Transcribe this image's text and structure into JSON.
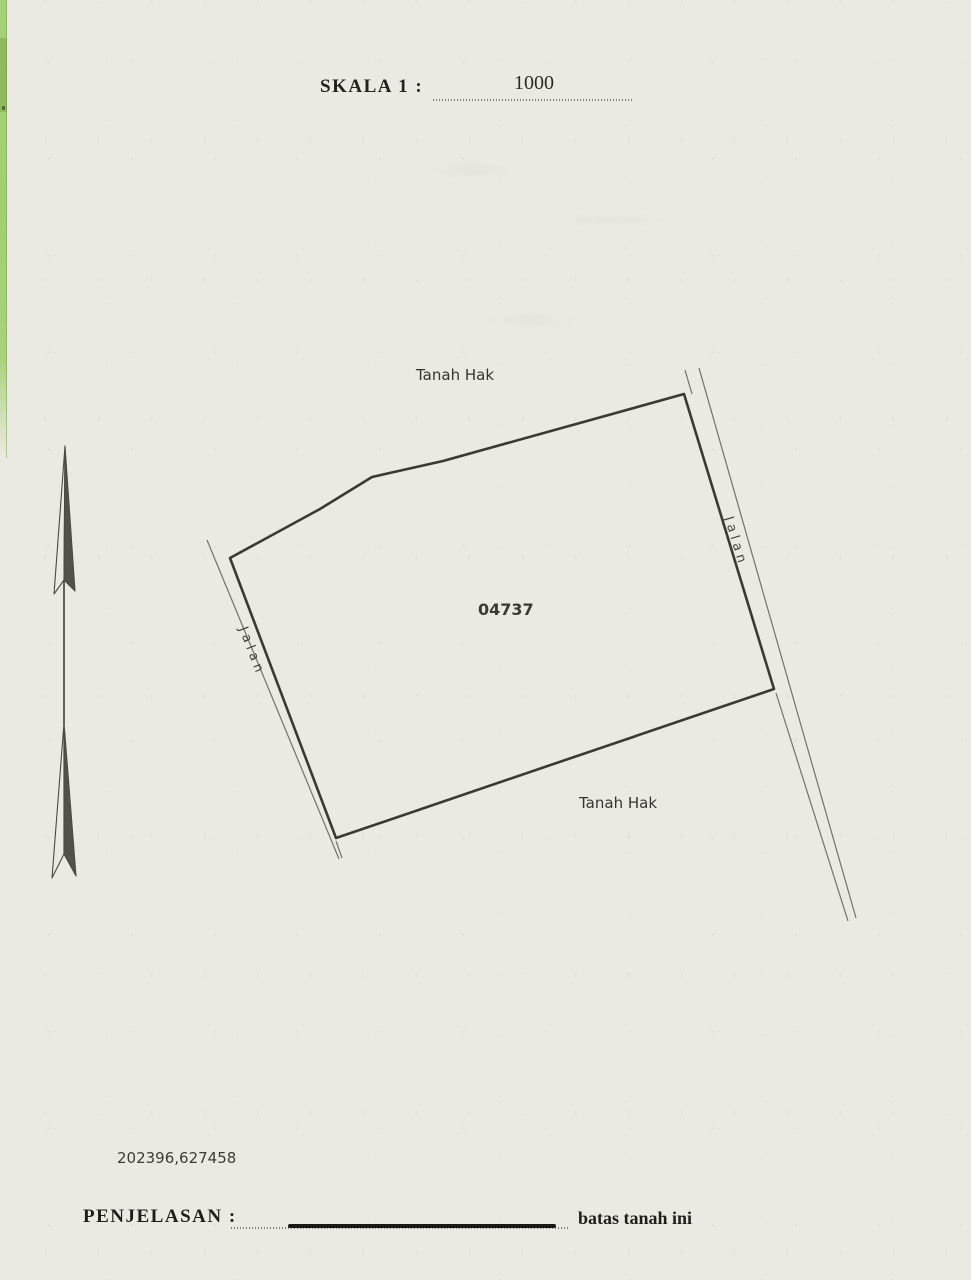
{
  "document": {
    "paper_color": "#ebeae2",
    "ink_color": "#3a3a33",
    "margin_strip_color": "#a4cf74"
  },
  "header": {
    "scale_label": "SKALA 1 :",
    "scale_value": "1000"
  },
  "map": {
    "parcel": {
      "number": "04737",
      "points": "230,558 320,509 372,477 443,461 684,394 774,689 336,838"
    },
    "adjacent_labels": {
      "top": "Tanah Hak",
      "bottom": "Tanah Hak"
    },
    "roads": {
      "left_label": "Jalan",
      "right_label": "Jalan",
      "left_outer": "M207,540 L339,859",
      "left_inner_ext": "M336,841 L342,858",
      "right_outer": "M699,368 L856,918",
      "right_inner_top": "M685,370 L692,394",
      "right_inner_bottom": "M776,693 L848,921"
    }
  },
  "footer": {
    "coordinates": "202396,627458",
    "legend_label": "PENJELASAN  :",
    "legend_text": "batas tanah ini"
  }
}
